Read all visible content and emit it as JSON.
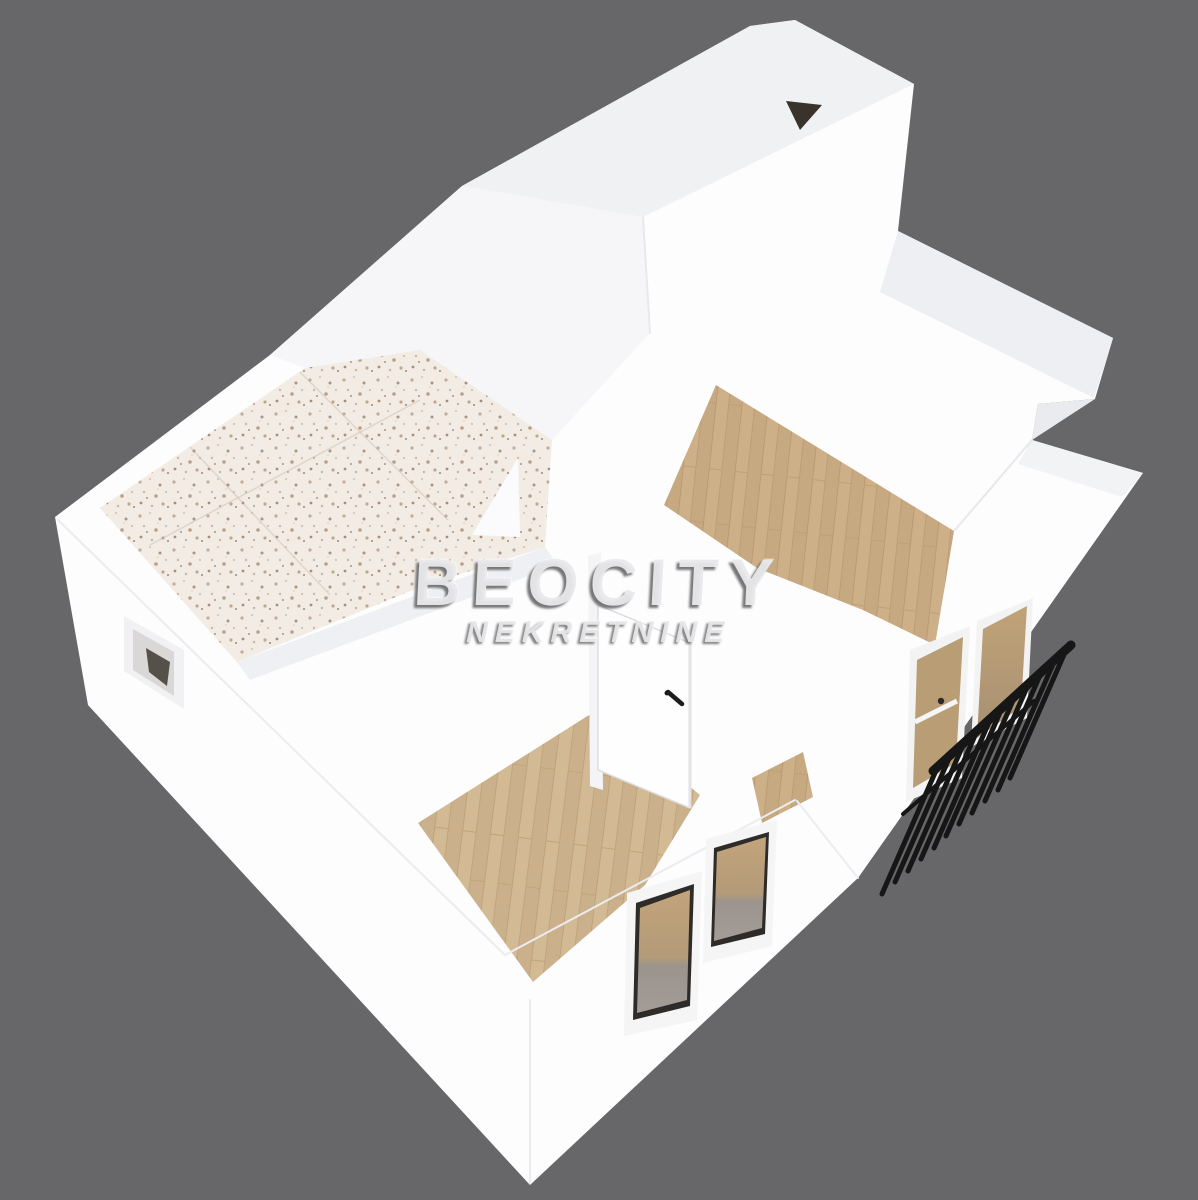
{
  "watermark": {
    "title": "BEOCITY",
    "subtitle": "NEKRETNINE"
  },
  "scene": {
    "type": "3d-floorplan-render",
    "background_color": "#67676a",
    "wall_color": "#fdfdfe",
    "wall_top_color": "#f0f1f3",
    "roof_opening_color": "#3a332b",
    "tile_base_color": "#f2ece5",
    "tile_speckle_color": "#b5a090",
    "wood_floor_color": "#cdb087",
    "wood_floor_light_color": "#d2ba95",
    "wood_plank_line_color": "#b3946c",
    "door_color": "#fefefe",
    "door_handle_color": "#1c1c1c",
    "window_frame_color": "#f5f5f6",
    "window_inner_frame_color": "#2e2b28",
    "glass_color": "#b89d75",
    "railing_color": "#161616",
    "features": [
      "tiled-bathroom-wall",
      "bedroom-wood-floor",
      "living-room-wood-floor",
      "interior-door",
      "front-facade-windows",
      "bathroom-window",
      "balcony-door",
      "balcony-railing",
      "roof-opening"
    ]
  }
}
